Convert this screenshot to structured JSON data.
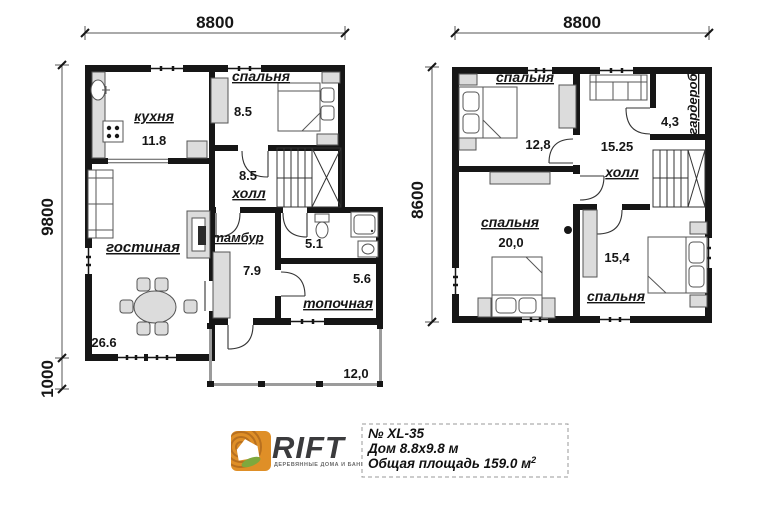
{
  "plan1": {
    "dim_top": "8800",
    "dim_side": "9800",
    "dim_side_lower": "1000",
    "kitchen_label": "кухня",
    "kitchen_area": "11.8",
    "bedroom_label": "спальня",
    "bedroom_area": "8.5",
    "hall_label": "холл",
    "hall_area": "8.5",
    "living_label": "гостиная",
    "living_area": "26.6",
    "vestibule_label": "тамбур",
    "vestibule_area": "7.9",
    "bathroom_area": "5.1",
    "boiler_label": "топочная",
    "boiler_area": "5.6",
    "terrace_area": "12,0"
  },
  "plan2": {
    "dim_top": "8800",
    "dim_side": "8600",
    "bedroom1_label": "спальня",
    "bedroom1_area": "12,8",
    "hall_label": "холл",
    "hall_area": "15.25",
    "wardrobe_label": "гардероб",
    "wardrobe_area": "4,3",
    "bedroom2_label": "спальня",
    "bedroom2_area": "20,0",
    "bedroom3_label": "спальня",
    "bedroom3_area": "15,4"
  },
  "footer": {
    "brand": "RIFT",
    "tagline": "ДЕРЕВЯННЫЕ ДОМА И БАНИ",
    "model": "№ XL-35",
    "dimensions": "Дом 8.8x9.8 м",
    "total_area": "Общая площадь 159.0 м",
    "total_area_sup": "2",
    "logo_orange": "#DF8F27",
    "logo_green": "#7EA83D"
  }
}
